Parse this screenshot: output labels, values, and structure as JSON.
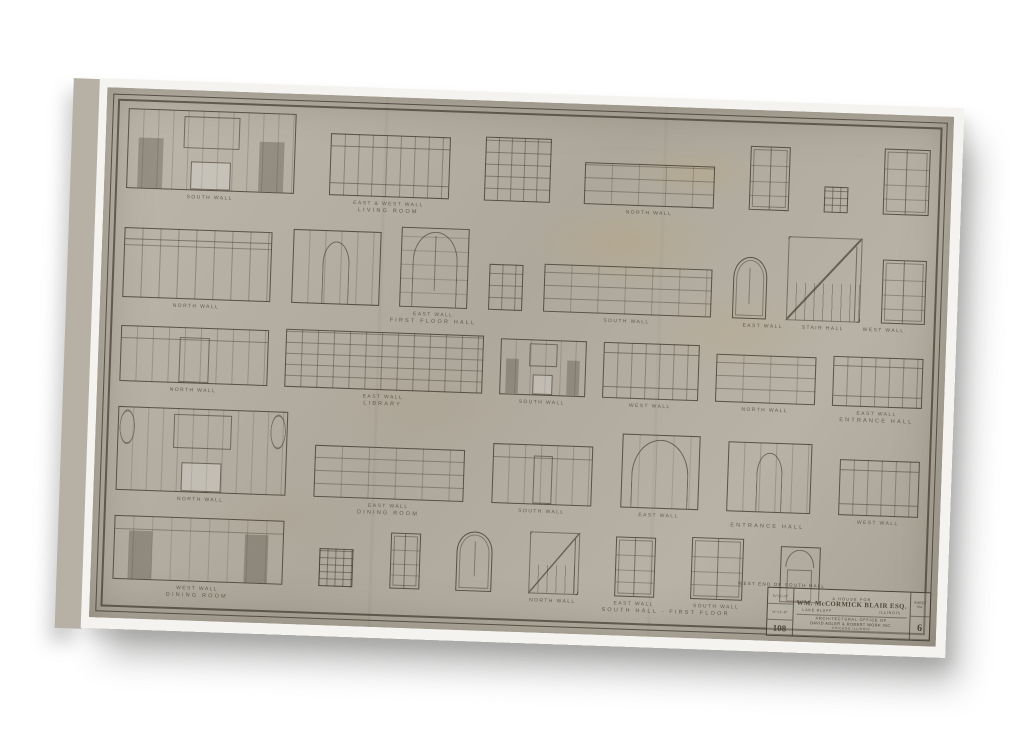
{
  "artwork": {
    "kind": "architectural interior elevation sheet printed on gallery-wrapped canvas",
    "titleblock": {
      "caption": "WEST END OF SOUTH HALL",
      "project_line1": "A HOUSE FOR",
      "project_line2": "WM. McCORMICK BLAIR ESQ.",
      "location_left": "LAKE BLUFF",
      "location_right": "ILLINOIS",
      "firm_line1": "ARCHITECTURAL OFFICE OF",
      "firm_line2": "DAVID ADLER & ROBERT WORK INC.",
      "firm_line3": "CHICAGO ILLINOIS",
      "scale_value_1": "¾″=1′-0″",
      "scale_value_2": "⅛″=1′-0″",
      "job_number": "108",
      "sheet_label": "SHEET No.",
      "sheet_number": "6"
    }
  },
  "colors": {
    "paper": "#b5afa4",
    "ink": "#463f33",
    "canvas_margin": "#f4f3ef",
    "page_background": "#ffffff",
    "stain": "#c1a35f",
    "shadow": "#626260"
  },
  "rows": [
    {
      "name": "living-room",
      "items": [
        {
          "type": "mantel-wall",
          "w": 168,
          "h": 80,
          "label": "SOUTH WALL"
        },
        {
          "type": "panel-wall",
          "w": 120,
          "h": 62,
          "label": "EAST & WEST WALL",
          "sublabel": "LIVING ROOM"
        },
        {
          "type": "cabinet",
          "w": 66,
          "h": 64
        },
        {
          "type": "lowwall",
          "w": 130,
          "h": 42,
          "label": "NORTH WALL"
        },
        {
          "type": "door",
          "w": 40,
          "h": 64
        },
        {
          "type": "window",
          "w": 24,
          "h": 26
        },
        {
          "type": "door6",
          "w": 46,
          "h": 66
        }
      ]
    },
    {
      "name": "first-floor-hall",
      "items": [
        {
          "type": "arch-wall",
          "w": 148,
          "h": 70,
          "label": "NORTH WALL"
        },
        {
          "type": "arch-door-wall",
          "w": 88,
          "h": 74
        },
        {
          "type": "big-arch-door",
          "w": 68,
          "h": 80,
          "label": "EAST WALL",
          "sublabel": "FIRST FLOOR HALL"
        },
        {
          "type": "cabinet",
          "w": 34,
          "h": 46
        },
        {
          "type": "lowwall",
          "w": 168,
          "h": 48,
          "label": "SOUTH WALL"
        },
        {
          "type": "arch-door",
          "w": 34,
          "h": 62
        },
        {
          "type": "stair",
          "w": 74,
          "h": 84,
          "label": "STAIR HALL",
          "label_left": "EAST WALL",
          "label_right": "WEST WALL"
        },
        {
          "type": "door6",
          "w": 44,
          "h": 64
        }
      ]
    },
    {
      "name": "library",
      "items": [
        {
          "type": "door-wall",
          "w": 148,
          "h": 56,
          "label": "NORTH WALL"
        },
        {
          "type": "bookcase",
          "w": 198,
          "h": 58,
          "label": "EAST WALL",
          "sublabel": "LIBRARY"
        },
        {
          "type": "mantel-small",
          "w": 86,
          "h": 56,
          "label": "SOUTH WALL"
        },
        {
          "type": "panel-wall",
          "w": 96,
          "h": 56,
          "label": "WEST WALL"
        },
        {
          "type": "lowwall",
          "w": 100,
          "h": 48,
          "label": "NORTH WALL"
        },
        {
          "type": "panel-wall",
          "w": 90,
          "h": 50,
          "label": "EAST WALL",
          "sublabel": "ENTRANCE HALL"
        }
      ]
    },
    {
      "name": "dining-room-entrance-hall",
      "items": [
        {
          "type": "mantel-arch-wall",
          "w": 170,
          "h": 84,
          "label": "NORTH WALL"
        },
        {
          "type": "lowwall",
          "w": 150,
          "h": 52,
          "label": "EAST WALL",
          "sublabel": "DINING ROOM"
        },
        {
          "type": "door-wall",
          "w": 100,
          "h": 60,
          "label": "SOUTH WALL"
        },
        {
          "type": "big-arch",
          "w": 78,
          "h": 74,
          "label": "EAST WALL"
        },
        {
          "type": "arch-door-wall",
          "w": 84,
          "h": 70,
          "sublabel": "ENTRANCE HALL"
        },
        {
          "type": "panel-wall",
          "w": 80,
          "h": 56,
          "label": "WEST WALL"
        }
      ]
    },
    {
      "name": "south-hall-first-floor",
      "width": "88%",
      "items": [
        {
          "type": "door-wall2",
          "w": 170,
          "h": 64,
          "label": "WEST WALL",
          "sublabel": "DINING ROOM"
        },
        {
          "type": "window",
          "w": 34,
          "h": 38
        },
        {
          "type": "door",
          "w": 30,
          "h": 56
        },
        {
          "type": "arch-door",
          "w": 36,
          "h": 60
        },
        {
          "type": "stair-small",
          "w": 50,
          "h": 62,
          "label": "NORTH WALL"
        },
        {
          "type": "door6",
          "w": 40,
          "h": 60,
          "label": "EAST WALL",
          "sublabel": "SOUTH HALL - FIRST FLOOR"
        },
        {
          "type": "double-door",
          "w": 52,
          "h": 62,
          "label": "SOUTH WALL"
        },
        {
          "type": "fan-door",
          "w": 40,
          "h": 56
        }
      ]
    }
  ]
}
